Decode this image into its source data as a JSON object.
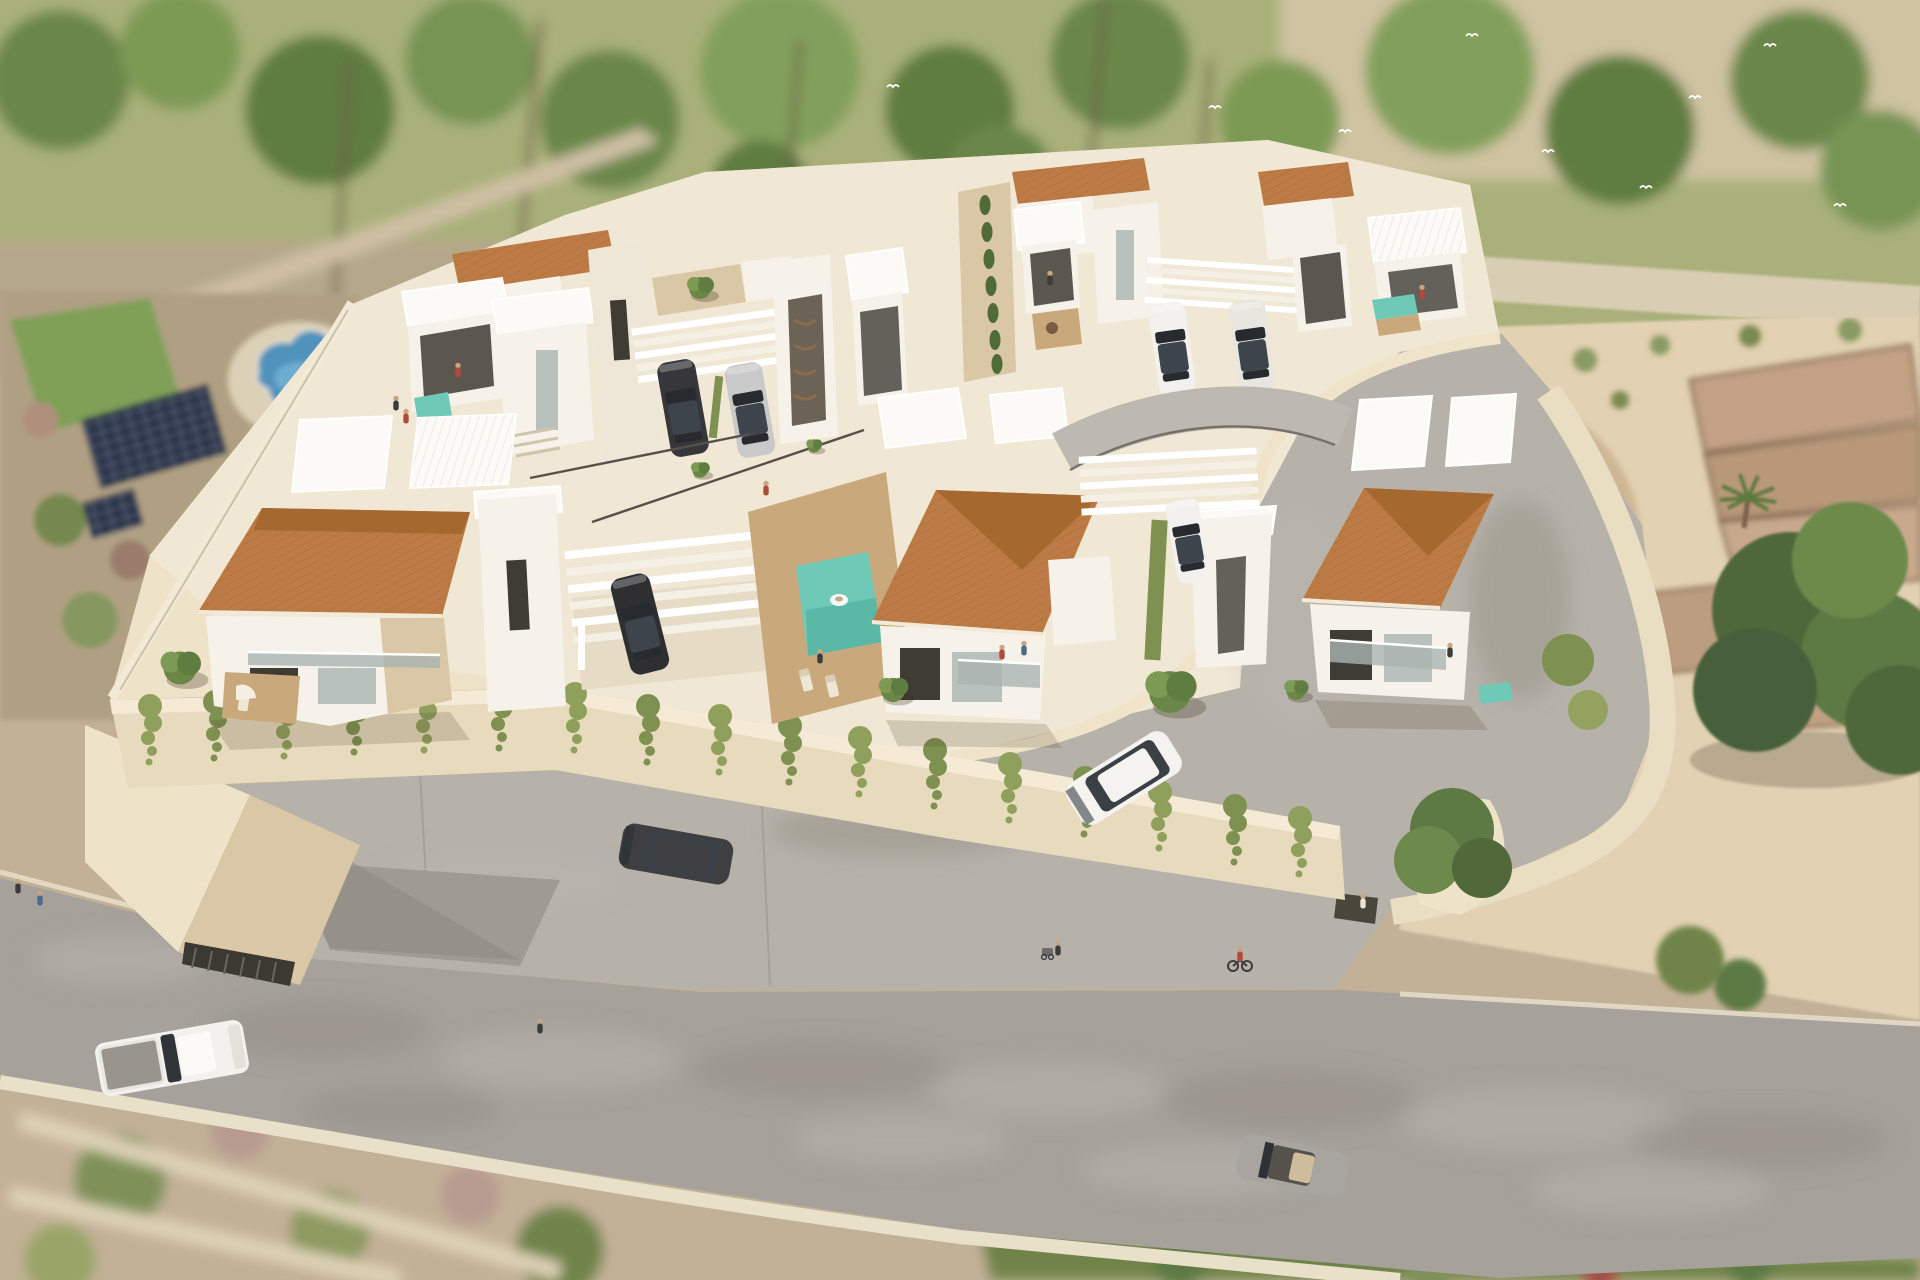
{
  "image": {
    "kind": "3D architectural aerial rendering",
    "subject": "Gated hillside development of modern two-storey villas with terracotta hip roofs, white flat-roof volumes, box balconies and pergola carports on a terraced cream-walled corner plot",
    "environment": "Blurred surroundings: pine and palm trees behind, neighbouring plot with free-form pool and rooftop solar panels at left, vacant sandy lot with old stone terrace walls at right, curving grey asphalt road across the foreground",
    "no_visible_text": true
  },
  "counts": {
    "terracotta_roofs": 7,
    "white_flat_roof_volumes": 14,
    "pergola_carports": 3,
    "swimming_pools": 5,
    "parked_cars": 7,
    "cars_on_road": 4,
    "people": 15,
    "bicycles": 1,
    "solar_panel_arrays": 2,
    "palm_trees": 6,
    "large_trees_right": 2
  },
  "vehicles": [
    {
      "label": "dark SUV under left pergola carport",
      "color_key": "car_dark"
    },
    {
      "label": "silver car beside dark SUV",
      "color_key": "car_silver"
    },
    {
      "label": "two white cars under upper-right pergola",
      "color_key": "car_white"
    },
    {
      "label": "dark car under central pergola",
      "color_key": "car_dark"
    },
    {
      "label": "white car under middle-right pergola",
      "color_key": "car_white"
    },
    {
      "label": "white SUV driving on inner loop road",
      "color_key": "car_white"
    },
    {
      "label": "dark car on concrete apron",
      "color_key": "car_dark"
    },
    {
      "label": "white pickup truck on main road",
      "color_key": "car_white"
    },
    {
      "label": "grey open-top car on main road",
      "color_key": "car_grey"
    }
  ],
  "landscape": {
    "hedge": "olive hedge with white flowering shrubs along road edge",
    "vines": "cascading green vines over cream retaining wall",
    "right_lot": "sand with ruined stone terrace walls and palm",
    "left_lot": "lawn, free-form blue pool, solar panel arrays"
  },
  "palette": {
    "wall_white": "#f6f2e9",
    "wall_cream": "#eee2c8",
    "wall_shade": "#d9c7a6",
    "slab_white": "#fbfaf6",
    "roof_terracotta": "#bc7b45",
    "roof_terracotta_dark": "#a5682f",
    "pool_teal": "#6fc9b7",
    "deck_wood": "#c9a87c",
    "road_asphalt": "#a6a19a",
    "inner_road": "#b7b2a9",
    "curb_cream": "#e9e0ca",
    "hedge_olive": "#93a25e",
    "tree_green": "#6b8748",
    "lawn_green": "#7fa057",
    "sand": "#e2d1b2",
    "terrain_tan": "#c3b197",
    "solar_blue": "#25304a",
    "car_dark": "#37363a",
    "car_silver": "#c9c9c9",
    "car_white": "#f2f1ed",
    "car_grey": "#a8a5a0",
    "pool_blue_neighbor": "#4f92bb",
    "glass": "#a9b4b2",
    "window_dark": "#3f3c34"
  }
}
